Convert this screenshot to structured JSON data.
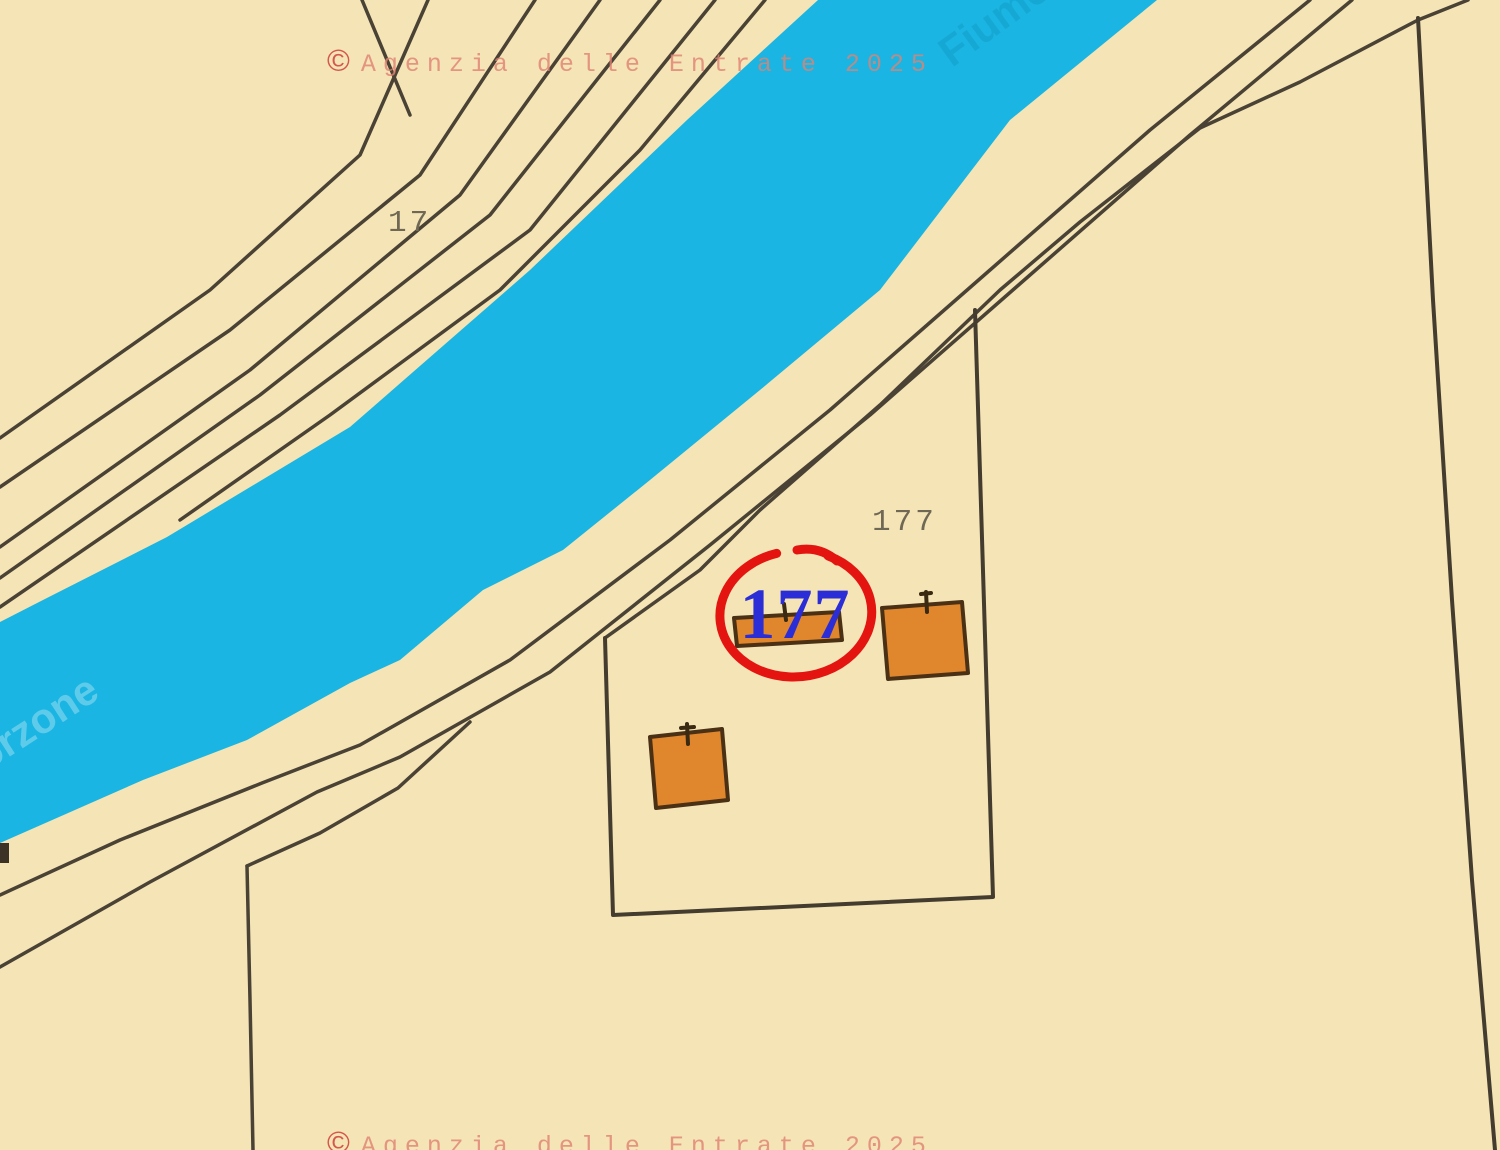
{
  "map": {
    "type": "cadastral-map",
    "attribution_symbol": "©",
    "attribution_text": "Agenzia delle Entrate 2025"
  },
  "parcels": {
    "parcel_17_label": "17",
    "parcel_177_label": "177"
  },
  "highlight": {
    "label": "177",
    "ring_color": "#e41410",
    "label_color": "#2b2ed6"
  },
  "river": {
    "name_fragment_top": "Fiume",
    "name_fragment_bottom": "orzone",
    "water_color": "#1ab5e2"
  },
  "buildings": [
    {
      "name": "building-strip-under-177"
    },
    {
      "name": "building-square-east"
    },
    {
      "name": "building-square-south"
    }
  ],
  "colors": {
    "land": "#f4e4b6",
    "water": "#1ab5e2",
    "boundary_line": "#4a4234",
    "building_fill": "#e0862d",
    "building_stroke": "#4a3014",
    "parcel_number_text": "#6f6855",
    "watermark_text": "#e08273",
    "watermark_symbol": "#d4574e"
  }
}
